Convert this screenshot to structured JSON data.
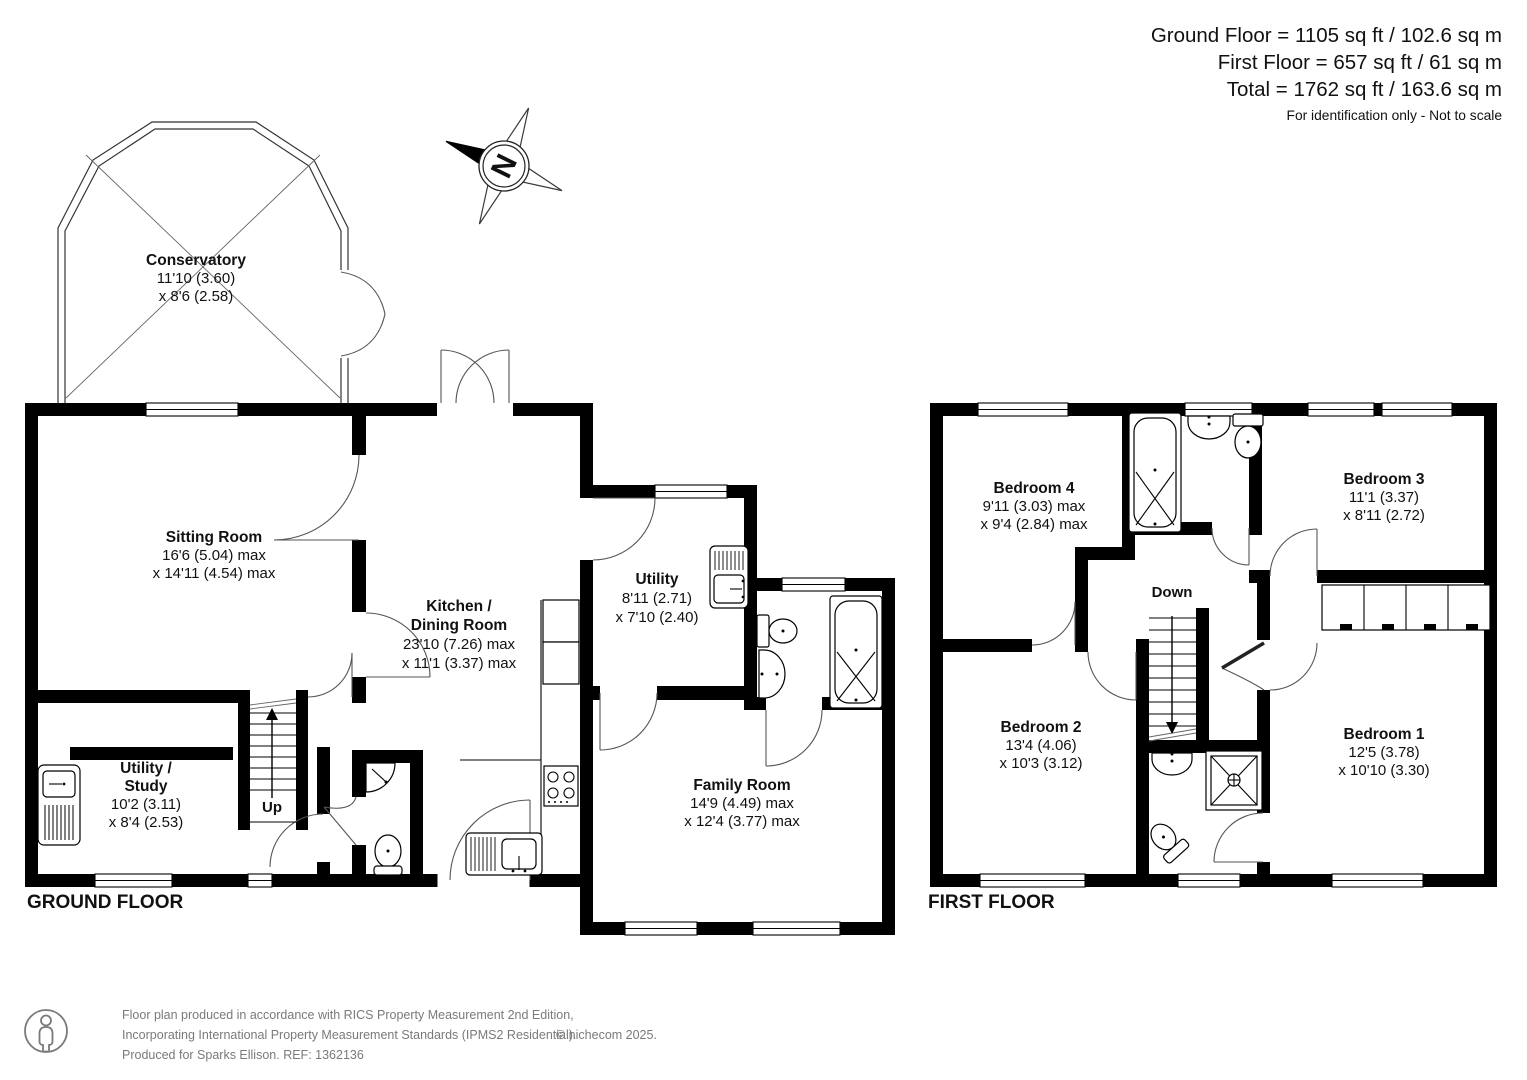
{
  "header": {
    "ground_floor_area": "Ground Floor = 1105 sq ft / 102.6 sq m",
    "first_floor_area": "First Floor = 657 sq ft / 61 sq m",
    "total_area": "Total = 1762 sq ft / 163.6 sq m",
    "disclaimer": "For identification only - Not to scale"
  },
  "compass": {
    "north_label": "N"
  },
  "ground_floor": {
    "title": "GROUND FLOOR",
    "stairs_label": "Up",
    "rooms": {
      "conservatory": {
        "lines": [
          "Conservatory",
          "11'10 (3.60)",
          "x 8'6 (2.58)"
        ]
      },
      "sitting_room": {
        "lines": [
          "Sitting Room",
          "16'6 (5.04) max",
          "x 14'11 (4.54) max"
        ]
      },
      "kitchen_dining_room": {
        "lines": [
          "Kitchen /",
          "Dining Room",
          "23'10 (7.26) max",
          "x 11'1 (3.37) max"
        ]
      },
      "utility": {
        "lines": [
          "Utility",
          "8'11 (2.71)",
          "x 7'10 (2.40)"
        ]
      },
      "utility_study": {
        "lines": [
          "Utility  /",
          "Study",
          "10'2 (3.11)",
          "x 8'4 (2.53)"
        ]
      },
      "family_room": {
        "lines": [
          "Family Room",
          "14'9 (4.49) max",
          "x 12'4 (3.77) max"
        ]
      }
    }
  },
  "first_floor": {
    "title": "FIRST FLOOR",
    "stairs_label": "Down",
    "rooms": {
      "bedroom_4": {
        "lines": [
          "Bedroom 4",
          "9'11 (3.03) max",
          "x 9'4 (2.84) max"
        ]
      },
      "bedroom_3": {
        "lines": [
          "Bedroom 3",
          "11'1 (3.37)",
          "x 8'11 (2.72)"
        ]
      },
      "bedroom_2": {
        "lines": [
          "Bedroom 2",
          "13'4 (4.06)",
          "x 10'3 (3.12)"
        ]
      },
      "bedroom_1": {
        "lines": [
          "Bedroom 1",
          "12'5 (3.78)",
          "x 10'10 (3.30)"
        ]
      }
    }
  },
  "footer": {
    "line1": "Floor plan produced in accordance with RICS Property Measurement 2nd Edition,",
    "line2": "Incorporating International Property Measurement Standards (IPMS2 Residential).",
    "copyright": "© nichecom 2025.",
    "line3": "Produced for Sparks Ellison.   REF: 1362136"
  }
}
